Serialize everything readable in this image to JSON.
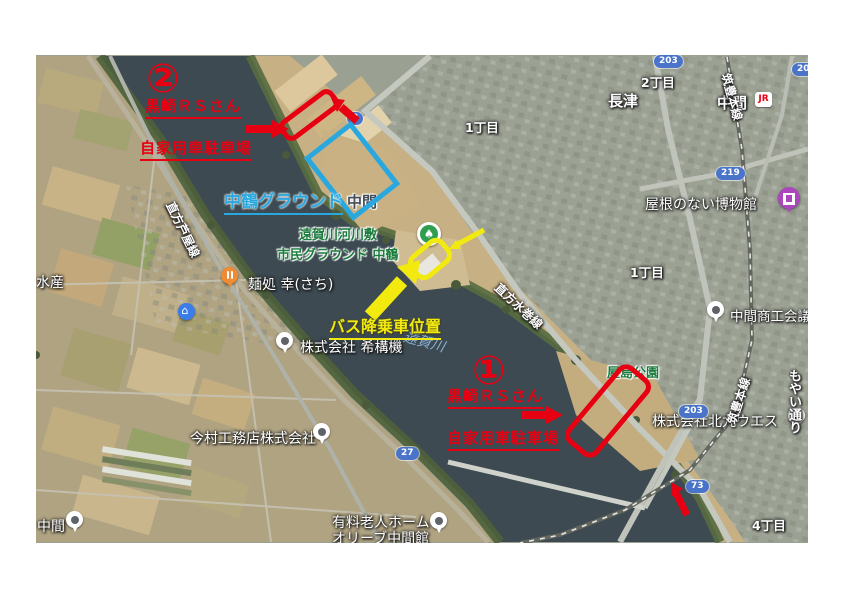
{
  "annotations": {
    "marker2": {
      "num": "②",
      "team": "黒崎ＲＳさん",
      "parking": "自家用車駐車場"
    },
    "marker1": {
      "num": "①",
      "team": "黒崎ＲＳさん",
      "parking": "自家用車駐車場"
    },
    "ground": "中鶴グラウンド",
    "bus_position": "バス降乗車位置",
    "colors": {
      "red": "#e60012",
      "blue": "#29a8e0",
      "yellow": "#f2ea0f"
    }
  },
  "map_labels": {
    "park_line1": "遠賀川河川敷",
    "park_line2": "市民グラウンド 中鶴",
    "nakama_area": "中間",
    "river": "遠賀川",
    "yashima_park": "屋島公園",
    "districts": {
      "chome1_top": "1丁目",
      "chome2": "2丁目",
      "nagatsu": "長津",
      "chome1_right": "1丁目",
      "chome4": "4丁目",
      "nakama_bottom": "中間"
    },
    "station": {
      "name": "中間",
      "jr": "JR"
    },
    "businesses": {
      "roofless_museum": "屋根のない博物館",
      "shoko": "中間商工会議所",
      "wes": "株式会社北九ウエス",
      "imamura": "今村工務店株式会社",
      "menya": "麺処 幸(さち)",
      "kikouki": "株式会社 希構機",
      "suisan": "水産",
      "elder_line1": "有料老人ホーム",
      "elder_line2": "オリーブ中間館"
    },
    "roads": {
      "ashiya": "直方芦屋線",
      "mizumaki": "直方水巻線",
      "chikuho": "筑豊本線",
      "moyai": "もやい通り"
    },
    "shields": {
      "r3": "3",
      "r203": "203",
      "r219": "219",
      "r27": "27",
      "r73": "73"
    }
  }
}
